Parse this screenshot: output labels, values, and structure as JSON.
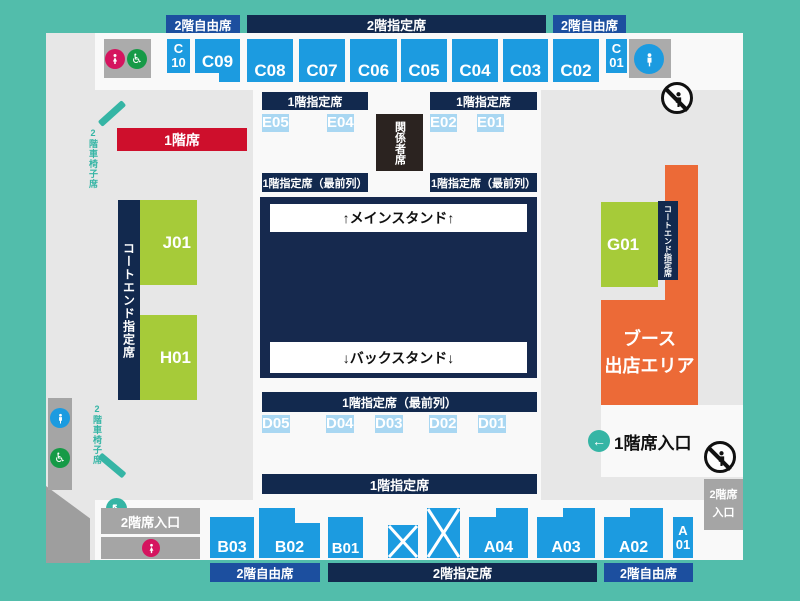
{
  "palette": {
    "background_teal": "#52BDAB",
    "map_gray": "#E7E7E7",
    "walk_white": "#F9F9F9",
    "navy": "#12294E",
    "court_navy": "#16294E",
    "free_seat_blue": "#1C4F9F",
    "seat_blue": "#1C9BE0",
    "seat_lightblue": "#A9D7F2",
    "front_row_yellow": "#EDE96E",
    "court_end_green": "#A6CB39",
    "booth_orange": "#EC6A37",
    "floor1_red": "#CE0F2C",
    "toilet_pink": "#D5145F",
    "accessible_green": "#169A47",
    "entrance_gray": "#A5A5A5",
    "accent_teal": "#35B5A5",
    "officials_dark": "#2B2320"
  },
  "bars": {
    "free": "2階自由席",
    "reserved": "2階指定席"
  },
  "labels": {
    "floor1": "1階席",
    "f1_reserved": "1階指定席",
    "f1_front": "1階指定席（最前列）",
    "officials": "関係者席",
    "court_end": "コートエンド指定席",
    "main_stand": "↑メインスタンド↑",
    "back_stand": "↓バックスタンド↓",
    "booth": "ブース\n出店エリア",
    "wheelchair2f": "2階車椅子席",
    "ent1f": "1階席入口",
    "ent2f": "2階席入口",
    "ent2f_right": "2階席\n入口"
  },
  "seats": {
    "c10": "C\n10",
    "c09": "C09",
    "c08": "C08",
    "c07": "C07",
    "c06": "C06",
    "c05": "C05",
    "c04": "C04",
    "c03": "C03",
    "c02": "C02",
    "c01": "C\n01",
    "e05": "E05",
    "e04": "E04",
    "e02": "E02",
    "e01": "E01",
    "d05": "D05",
    "d04": "D04",
    "d03": "D03",
    "d02": "D02",
    "d01": "D01",
    "j01": "J01",
    "h01": "H01",
    "g01": "G01",
    "b03": "B03",
    "b02": "B02",
    "b01": "B01",
    "a04": "A04",
    "a03": "A03",
    "a02": "A02",
    "a01": "A\n01"
  },
  "icons": {
    "arrow_left": "←",
    "arrow_upleft": "↖",
    "wheelchair_glyph": "♿"
  }
}
